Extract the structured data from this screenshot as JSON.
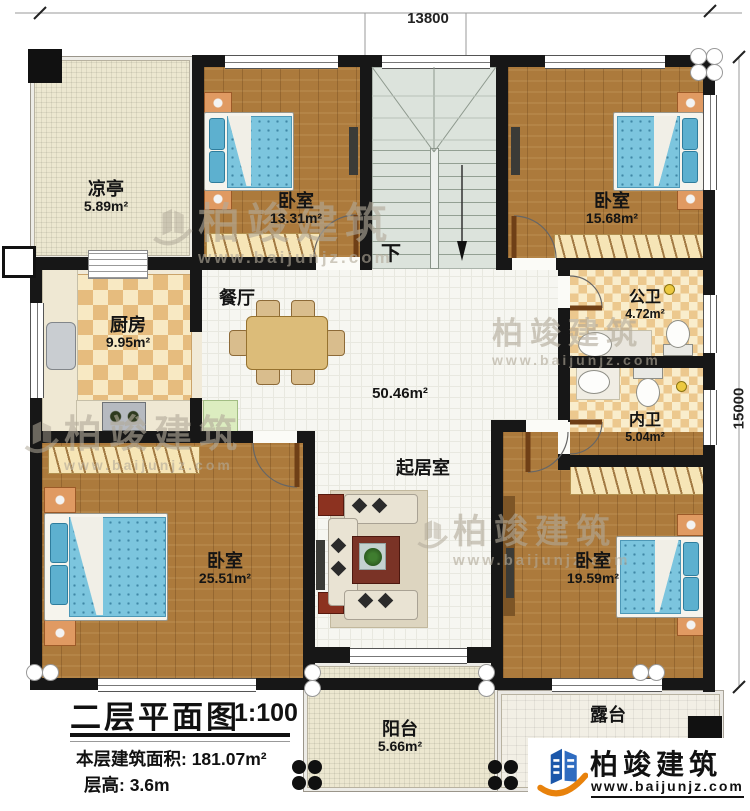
{
  "dimensions": {
    "width_label": "13800",
    "height_label": "15000"
  },
  "rooms": {
    "pavilion": {
      "label": "凉亭",
      "area": "5.89m²"
    },
    "bedroom_top_left": {
      "label": "卧室",
      "area": "13.31m²"
    },
    "bedroom_top_right": {
      "label": "卧室",
      "area": "15.68m²"
    },
    "kitchen": {
      "label": "厨房",
      "area": "9.95m²"
    },
    "dining": {
      "label": "餐厅"
    },
    "public_bath": {
      "label": "公卫",
      "area": "4.72m²"
    },
    "private_bath": {
      "label": "内卫",
      "area": "5.04m²"
    },
    "living": {
      "label": "起居室",
      "area": "50.46m²"
    },
    "bedroom_bottom_left": {
      "label": "卧室",
      "area": "25.51m²"
    },
    "bedroom_bottom_right": {
      "label": "卧室",
      "area": "19.59m²"
    },
    "balcony": {
      "label": "阳台",
      "area": "5.66m²"
    },
    "terrace": {
      "label": "露台"
    }
  },
  "stairs": {
    "direction_label": "下"
  },
  "title_block": {
    "title": "二层平面图",
    "scale": "1:100",
    "floor_area": "本层建筑面积: 181.07m²",
    "floor_height": "层高: 3.6m"
  },
  "brand": {
    "name": "柏竣建筑",
    "website": "www.baijunjz.com"
  },
  "watermark": {
    "name": "柏竣建筑",
    "website": "www.baijunjz.com"
  },
  "colors": {
    "wall": "#171717",
    "wood_floor": "#ac7a3c",
    "bed": "#7cc5de",
    "brand_blue": "#1b57aa",
    "brand_orange": "#e8820c"
  }
}
